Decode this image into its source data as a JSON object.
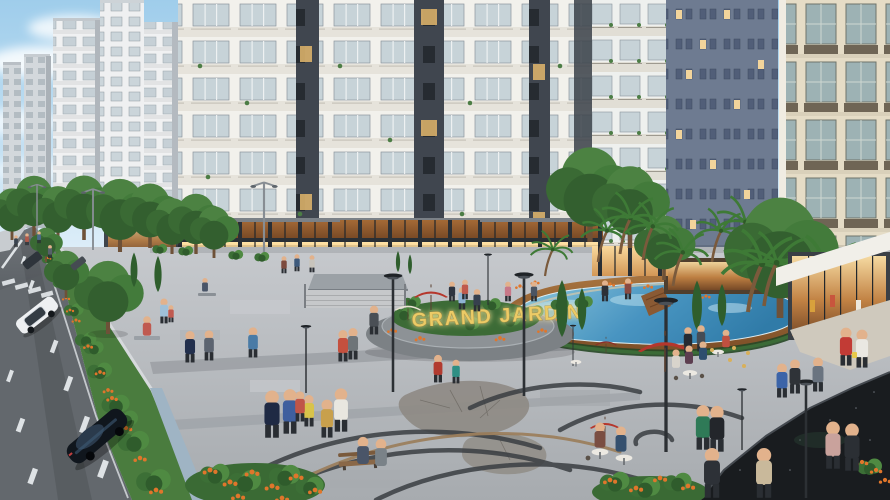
{
  "scene": {
    "type": "3D architectural rendering",
    "description": "Elevated view of a residential complex: white high-rise apartment towers over lit retail storefronts, a landscaped pedestrian plaza with a free-form blue swimming pool, a gold project-name sign on circular planter terraces, a tree-lined street with cars on the left, red patio umbrellas, street lamps, palm trees, flower beds and many strolling people.",
    "sign": {
      "text": "GRAND JARDIN",
      "letter_color": "#eccb66"
    },
    "features": [
      "apartment towers",
      "retail storefronts",
      "swimming pool",
      "pedestrian plaza",
      "street with cars",
      "red patio umbrellas",
      "street lamps",
      "palm trees",
      "flower beds",
      "crosswalk",
      "benches",
      "cafe tables"
    ]
  },
  "palette": {
    "sky_top": "#9fcdeb",
    "sky_horizon": "#e9f4fb",
    "facade_white": "#f2f1ec",
    "accent_column": "#40464f",
    "background_tower": "#6e7b91",
    "cream_tower": "#e5dcc6",
    "road": "#63686d",
    "plaza_light": "#c6c9cd",
    "plaza_dark": "#a7abaf",
    "verge_green": "#4a7c3e",
    "flower_orange": "#e0762b",
    "water_light": "#8fcbe2",
    "water_deep": "#2f7cab",
    "pool_deck_light": "#a8743f",
    "pool_deck_dark": "#7c4e27",
    "umbrella_red": "#b5372c",
    "wall_dark": "#191c1f",
    "swirl_dark": "#3a3e42"
  }
}
